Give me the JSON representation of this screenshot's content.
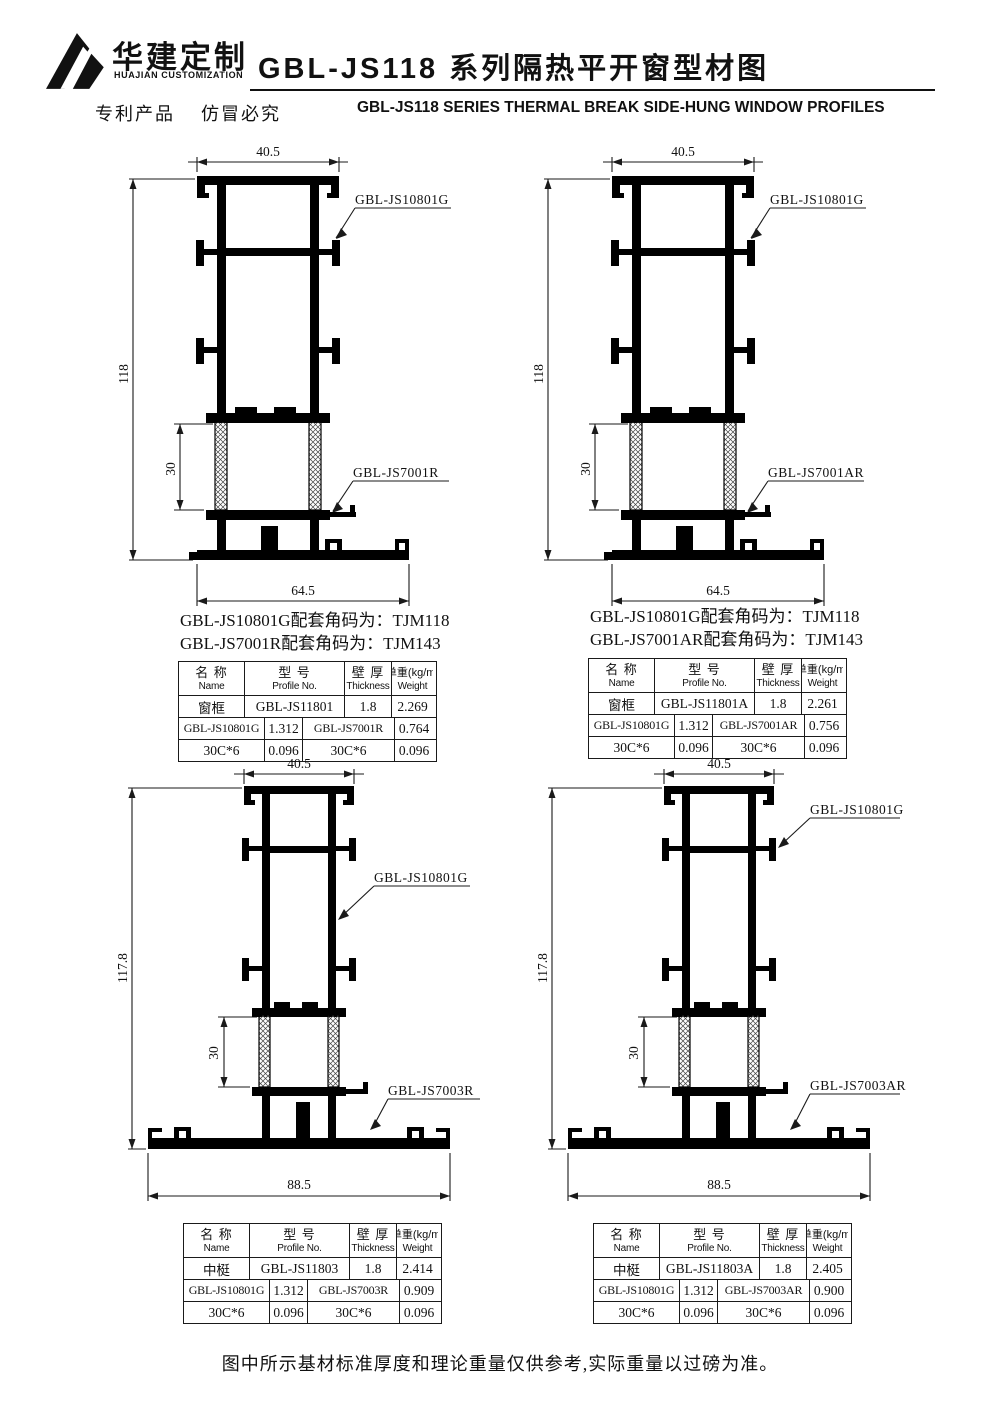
{
  "header": {
    "logo_cn": "华建定制",
    "logo_en": "HUAJIAN CUSTOMIZATION",
    "patent_notice": "专利产品    仿冒必究",
    "title_cn": "GBL-JS118 系列隔热平开窗型材图",
    "title_en": "GBL-JS118 SERIES THERMAL BREAK SIDE-HUNG WINDOW PROFILES"
  },
  "footer_note": "图中所示基材标准厚度和理论重量仅供参考,实际重量以过磅为准。",
  "table_header": {
    "name_cn": "名 称",
    "name_en": "Name",
    "model_cn": "型 号",
    "model_en": "Profile No.",
    "thick_cn": "壁 厚",
    "thick_en": "Thickness",
    "weight_cn": "单重(kg/m)",
    "weight_en": "Weight"
  },
  "drawings": {
    "tl": {
      "dim_top": "40.5",
      "dim_height": "118",
      "dim_inner": "30",
      "dim_bottom": "64.5",
      "label_main": "GBL-JS10801G",
      "label_part": "GBL-JS7001R",
      "note1": "GBL-JS10801G配套角码为：TJM118",
      "note2": "GBL-JS7001R配套角码为：TJM143",
      "rows": [
        [
          "窗框",
          "GBL-JS11801",
          "1.8",
          "2.269"
        ],
        [
          "GBL-JS10801G",
          "1.312",
          "GBL-JS7001R",
          "0.764"
        ],
        [
          "30C*6",
          "0.096",
          "30C*6",
          "0.096"
        ]
      ]
    },
    "tr": {
      "dim_top": "40.5",
      "dim_height": "118",
      "dim_inner": "30",
      "dim_bottom": "64.5",
      "label_main": "GBL-JS10801G",
      "label_part": "GBL-JS7001AR",
      "note1": "GBL-JS10801G配套角码为：TJM118",
      "note2": "GBL-JS7001AR配套角码为：TJM143",
      "rows": [
        [
          "窗框",
          "GBL-JS11801A",
          "1.8",
          "2.261"
        ],
        [
          "GBL-JS10801G",
          "1.312",
          "GBL-JS7001AR",
          "0.756"
        ],
        [
          "30C*6",
          "0.096",
          "30C*6",
          "0.096"
        ]
      ]
    },
    "bl": {
      "dim_top": "40.5",
      "dim_height": "117.8",
      "dim_inner": "30",
      "dim_bottom": "88.5",
      "label_main": "GBL-JS10801G",
      "label_part": "GBL-JS7003R",
      "rows": [
        [
          "中梃",
          "GBL-JS11803",
          "1.8",
          "2.414"
        ],
        [
          "GBL-JS10801G",
          "1.312",
          "GBL-JS7003R",
          "0.909"
        ],
        [
          "30C*6",
          "0.096",
          "30C*6",
          "0.096"
        ]
      ]
    },
    "br": {
      "dim_top": "40.5",
      "dim_height": "117.8",
      "dim_inner": "30",
      "dim_bottom": "88.5",
      "label_main": "GBL-JS10801G",
      "label_part": "GBL-JS7003AR",
      "rows": [
        [
          "中梃",
          "GBL-JS11803A",
          "1.8",
          "2.405"
        ],
        [
          "GBL-JS10801G",
          "1.312",
          "GBL-JS7003AR",
          "0.900"
        ],
        [
          "30C*6",
          "0.096",
          "30C*6",
          "0.096"
        ]
      ]
    }
  }
}
